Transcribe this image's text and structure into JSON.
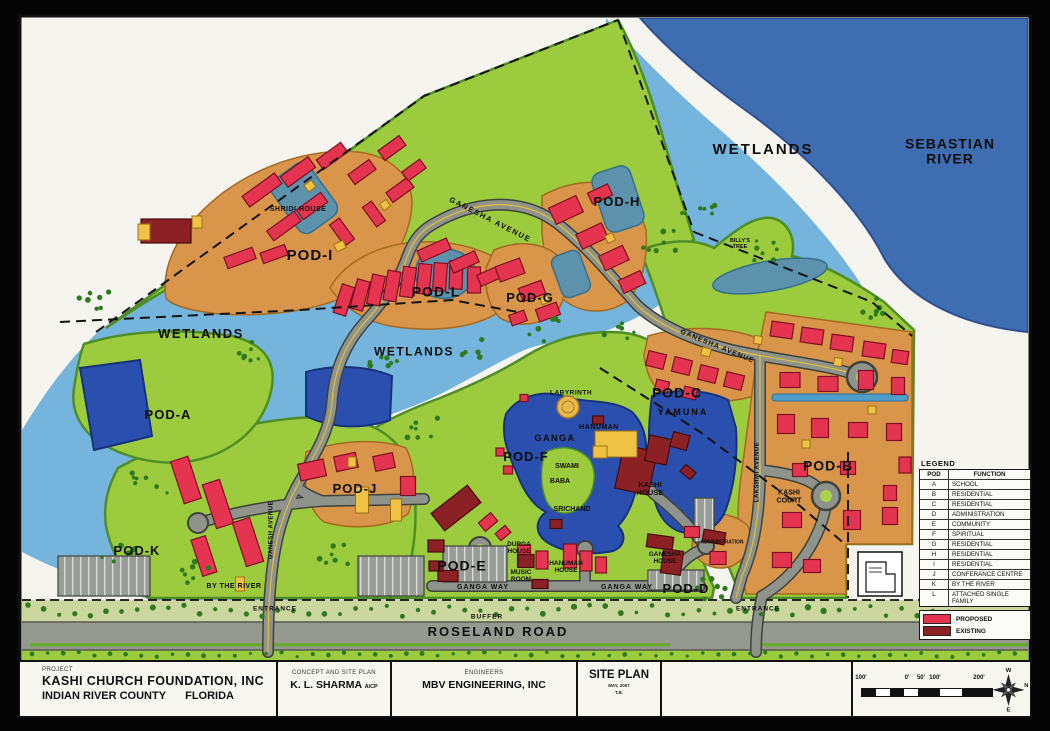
{
  "title_block": {
    "project_label": "PROJECT",
    "project_name": "KASHI CHURCH FOUNDATION, INC",
    "project_location": "INDIAN RIVER COUNTY",
    "project_state": "FLORIDA",
    "concept_label": "CONCEPT AND SITE PLAN",
    "planner": "K. L. SHARMA",
    "planner_credential": "AICP",
    "engineers_label": "ENGINEERS",
    "engineers_name": "MBV ENGINEERING, INC",
    "sheet_title": "SITE PLAN",
    "sheet_date": "MAY, 2007",
    "sheet_note": "T.B."
  },
  "scale_bar": {
    "ticks": [
      "100'",
      "0'",
      "50'",
      "100'",
      "200'"
    ]
  },
  "compass": {
    "n": "N",
    "s": "S",
    "e": "E",
    "w": "W"
  },
  "legend": {
    "title": "LEGEND",
    "col_pod": "POD",
    "col_function": "FUNCTION",
    "rows": [
      {
        "pod": "A",
        "function": "SCHOOL"
      },
      {
        "pod": "B",
        "function": "RESIDENTIAL"
      },
      {
        "pod": "C",
        "function": "RESIDENTIAL"
      },
      {
        "pod": "D",
        "function": "ADMINISTRATION"
      },
      {
        "pod": "E",
        "function": "COMMUNITY"
      },
      {
        "pod": "F",
        "function": "SPIRITUAL"
      },
      {
        "pod": "G",
        "function": "RESIDENTIAL"
      },
      {
        "pod": "H",
        "function": "RESIDENTIAL"
      },
      {
        "pod": "I",
        "function": "RESIDENTIAL"
      },
      {
        "pod": "J",
        "function": "CONFERANCE CENTRE"
      },
      {
        "pod": "K",
        "function": "BY THE RIVER"
      },
      {
        "pod": "L",
        "function": "ATTACHED SINGLE FAMILY"
      }
    ],
    "proposed_label": "PROPOSED",
    "existing_label": "EXISTING",
    "proposed_color": "#e43450",
    "existing_color": "#8c2125"
  },
  "map": {
    "labels": [
      {
        "id": "wetlands-ne",
        "text": "WETLANDS",
        "x": 763,
        "y": 150,
        "size": 15,
        "ls": 2
      },
      {
        "id": "sebastian-river",
        "text": "SEBASTIAN RIVER",
        "x": 950,
        "y": 152,
        "size": 14,
        "w": 112,
        "ls": 1
      },
      {
        "id": "shridi-house",
        "text": "SHRIDI HOUSE",
        "x": 298,
        "y": 210,
        "size": 7,
        "ls": 0.5
      },
      {
        "id": "pod-i",
        "text": "POD-I",
        "x": 310,
        "y": 256,
        "size": 15,
        "ls": 1
      },
      {
        "id": "pod-l",
        "text": "POD-L",
        "x": 436,
        "y": 292,
        "size": 14,
        "ls": 1
      },
      {
        "id": "ganesha-avenue-nw",
        "text": "GANESHA AVENUE",
        "x": 490,
        "y": 220,
        "size": 7.5,
        "rot": 27,
        "ls": 1.5
      },
      {
        "id": "pod-h",
        "text": "POD-H",
        "x": 617,
        "y": 202,
        "size": 13,
        "ls": 1
      },
      {
        "id": "pod-g",
        "text": "POD-G",
        "x": 530,
        "y": 298,
        "size": 13,
        "ls": 1
      },
      {
        "id": "billys-tree",
        "text": "BILLY'S TREE",
        "x": 740,
        "y": 244,
        "size": 5.5,
        "w": 32
      },
      {
        "id": "wetlands-w",
        "text": "WETLANDS",
        "x": 201,
        "y": 334,
        "size": 13,
        "ls": 1.5
      },
      {
        "id": "wetlands-c",
        "text": "WETLANDS",
        "x": 414,
        "y": 352,
        "size": 12,
        "ls": 1.5
      },
      {
        "id": "ganesha-avenue-e",
        "text": "GANESHA AVENUE",
        "x": 717,
        "y": 347,
        "size": 7,
        "rot": 22,
        "ls": 1
      },
      {
        "id": "pod-a",
        "text": "POD-A",
        "x": 168,
        "y": 415,
        "size": 13,
        "ls": 1
      },
      {
        "id": "pod-c",
        "text": "POD-C",
        "x": 677,
        "y": 393,
        "size": 14,
        "ls": 1
      },
      {
        "id": "yamuna",
        "text": "YAMUNA",
        "x": 683,
        "y": 413,
        "size": 9,
        "ls": 2
      },
      {
        "id": "labyrinth",
        "text": "LABYRINTH",
        "x": 571,
        "y": 393,
        "size": 6.5,
        "ls": 0.5
      },
      {
        "id": "hanuman",
        "text": "HANUMAN",
        "x": 599,
        "y": 428,
        "size": 7,
        "ls": 0.5
      },
      {
        "id": "ganga",
        "text": "GANGA",
        "x": 555,
        "y": 439,
        "size": 9,
        "ls": 1.5
      },
      {
        "id": "pod-f",
        "text": "POD-F",
        "x": 526,
        "y": 457,
        "size": 13,
        "ls": 1
      },
      {
        "id": "swami",
        "text": "SWAMI",
        "x": 567,
        "y": 467,
        "size": 7
      },
      {
        "id": "baba",
        "text": "BABA",
        "x": 560,
        "y": 482,
        "size": 7
      },
      {
        "id": "srichand",
        "text": "SRICHAND",
        "x": 572,
        "y": 510,
        "size": 7
      },
      {
        "id": "kashi-house",
        "text": "KASHI HOUSE",
        "x": 650,
        "y": 489,
        "size": 7.5,
        "w": 48
      },
      {
        "id": "pod-j",
        "text": "POD-J",
        "x": 355,
        "y": 489,
        "size": 13,
        "ls": 1
      },
      {
        "id": "pod-b",
        "text": "POD-B",
        "x": 828,
        "y": 466,
        "size": 14,
        "ls": 1
      },
      {
        "id": "kashi-court",
        "text": "KASHI COURT",
        "x": 789,
        "y": 497,
        "size": 7,
        "w": 42
      },
      {
        "id": "lakshmi-avenue",
        "text": "LAKSHMI AVENUE",
        "x": 758,
        "y": 472,
        "size": 6,
        "rot": -90,
        "ls": 0.5
      },
      {
        "id": "ganesh-avenue-s",
        "text": "GANESH AVENUE",
        "x": 272,
        "y": 530,
        "size": 6,
        "rot": -90,
        "ls": 0.5
      },
      {
        "id": "pod-k",
        "text": "POD-K",
        "x": 137,
        "y": 551,
        "size": 13,
        "ls": 1
      },
      {
        "id": "by-the-river",
        "text": "BY THE RIVER",
        "x": 234,
        "y": 587,
        "size": 7,
        "ls": 0.5
      },
      {
        "id": "pod-e",
        "text": "POD-E",
        "x": 462,
        "y": 566,
        "size": 14,
        "ls": 1
      },
      {
        "id": "durga-house",
        "text": "DURGA HOUSE",
        "x": 519,
        "y": 548,
        "size": 6.5,
        "w": 40
      },
      {
        "id": "music-room",
        "text": "MUSIC ROOM",
        "x": 521,
        "y": 576,
        "size": 6.5,
        "w": 36
      },
      {
        "id": "hanuman-house",
        "text": "HANUMAN HOUSE",
        "x": 566,
        "y": 567,
        "size": 6.5,
        "w": 52
      },
      {
        "id": "ganesha-house",
        "text": "GANESHA HOUSE",
        "x": 665,
        "y": 558,
        "size": 6.5,
        "w": 52
      },
      {
        "id": "administration",
        "text": "ADMINISTRATION",
        "x": 722,
        "y": 543,
        "size": 5
      },
      {
        "id": "pod-d",
        "text": "POD-D",
        "x": 686,
        "y": 589,
        "size": 13,
        "ls": 1
      },
      {
        "id": "ganga-way-w",
        "text": "GANGA WAY",
        "x": 483,
        "y": 588,
        "size": 7,
        "ls": 1
      },
      {
        "id": "ganga-way-e",
        "text": "GANGA WAY",
        "x": 627,
        "y": 588,
        "size": 7,
        "ls": 1
      },
      {
        "id": "entrance-w",
        "text": "ENTRANCE",
        "x": 275,
        "y": 609,
        "size": 6.5,
        "ls": 1
      },
      {
        "id": "entrance-e",
        "text": "ENTRANCE",
        "x": 758,
        "y": 609,
        "size": 6.5,
        "ls": 1
      },
      {
        "id": "buffer",
        "text": "BUFFER",
        "x": 487,
        "y": 617,
        "size": 6.5,
        "ls": 1
      },
      {
        "id": "roseland-road",
        "text": "ROSELAND ROAD",
        "x": 498,
        "y": 632,
        "size": 13,
        "ls": 2
      }
    ]
  }
}
